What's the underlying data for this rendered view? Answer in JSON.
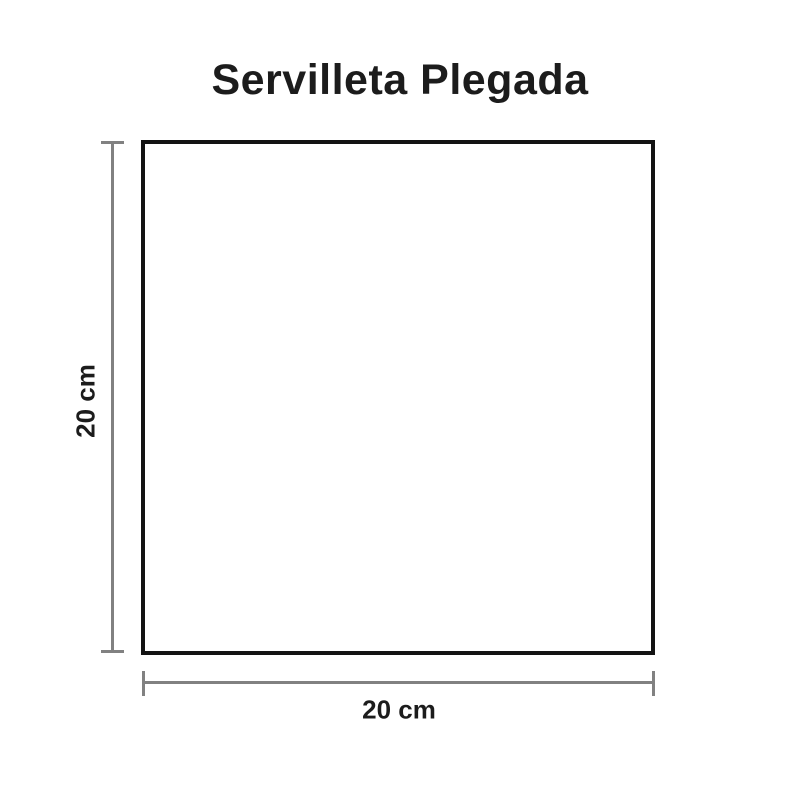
{
  "title": "Servilleta Plegada",
  "diagram": {
    "shape": "square",
    "dimensions": {
      "height_label": "20 cm",
      "width_label": "20 cm"
    }
  },
  "colors": {
    "text": "#1c1c1c",
    "dimension_line": "#818181",
    "shape_border": "#131313",
    "background": "#ffffff"
  }
}
